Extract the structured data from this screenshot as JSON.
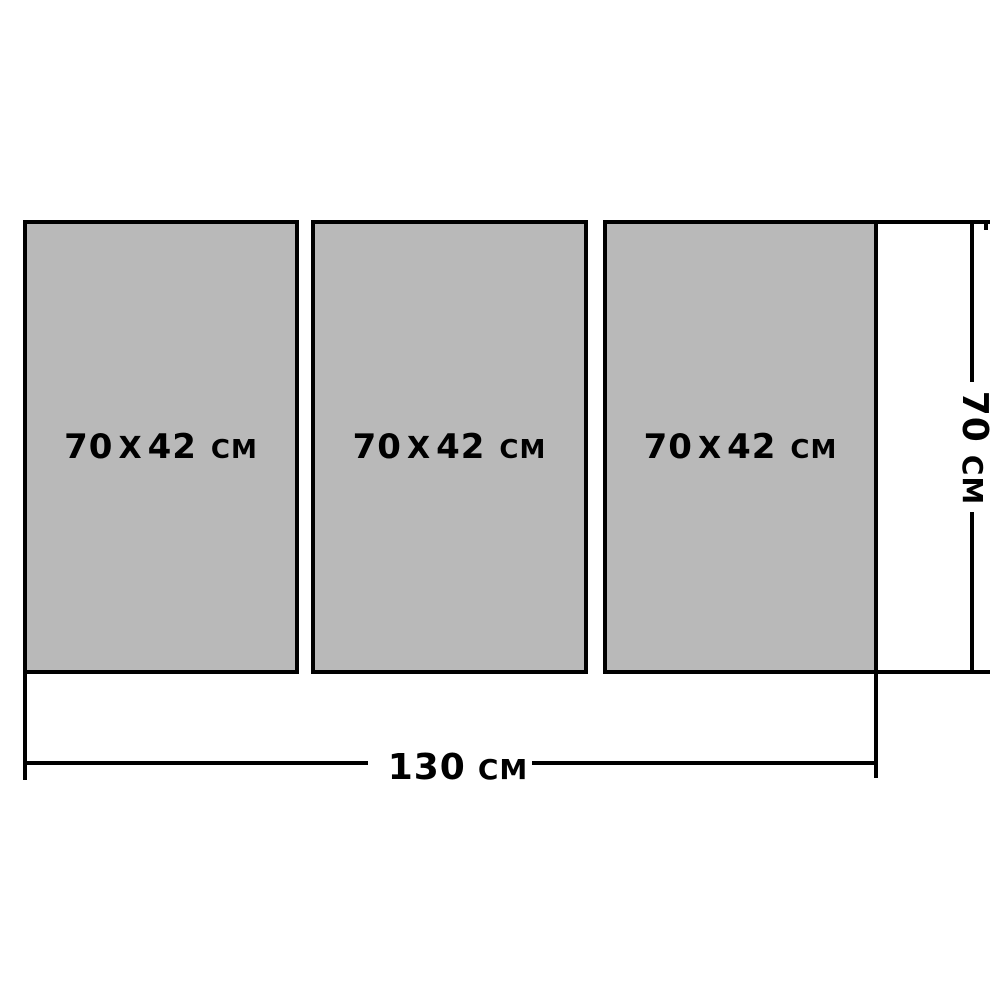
{
  "diagram": {
    "description_panels_count": "3",
    "panels": [
      {
        "width_value": "70",
        "separator": "Х",
        "height_value": "42",
        "unit": "СМ"
      },
      {
        "width_value": "70",
        "separator": "Х",
        "height_value": "42",
        "unit": "СМ"
      },
      {
        "width_value": "70",
        "separator": "Х",
        "height_value": "42",
        "unit": "СМ"
      }
    ],
    "dimensions": {
      "total_width": {
        "value": "130",
        "unit": "СМ"
      },
      "total_height": {
        "value": "70",
        "unit": "СМ"
      }
    },
    "colors": {
      "background": "#ffffff",
      "panel_fill": "#b9b9b9",
      "panel_border": "#000000",
      "dimension_line": "#000000",
      "label_text": "#000000"
    }
  }
}
